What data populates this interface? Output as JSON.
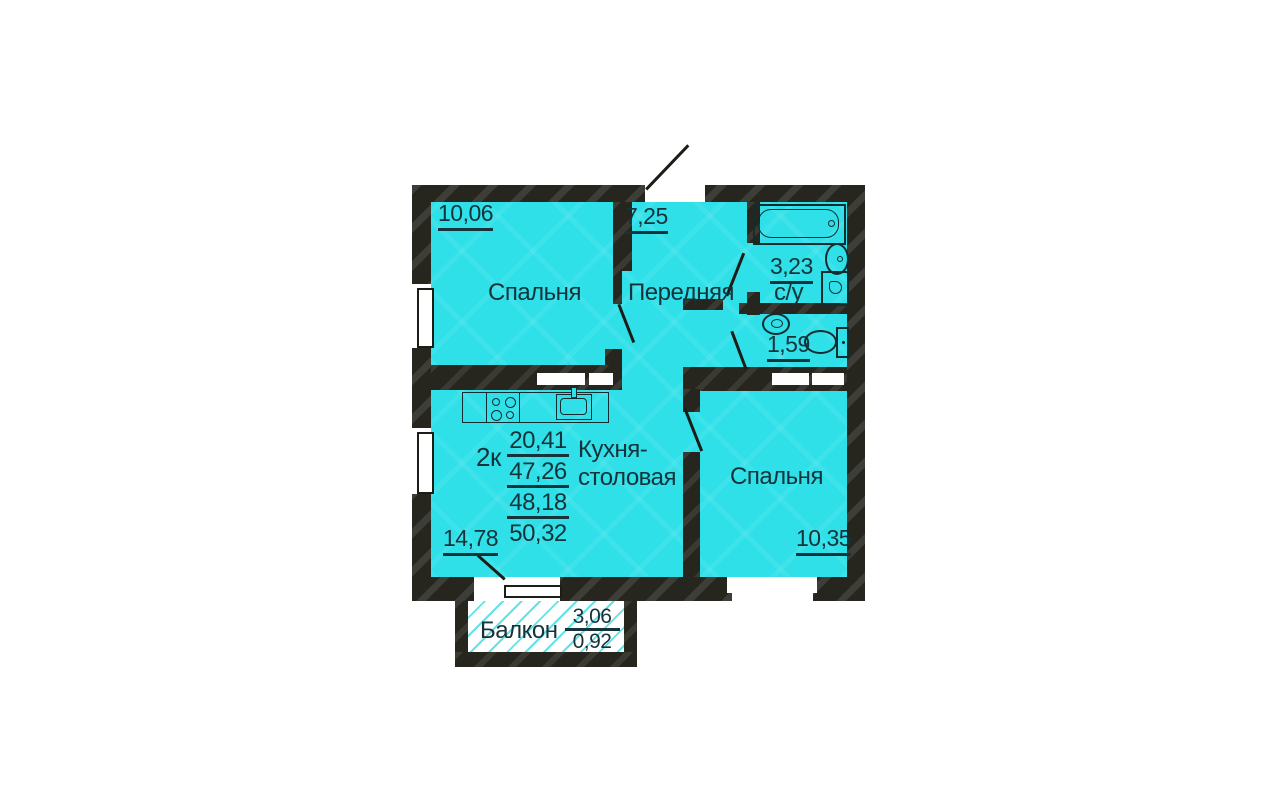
{
  "plan": {
    "apartment_summary": {
      "type_label": "2к",
      "areas": [
        "20,41",
        "47,26",
        "48,18",
        "50,32"
      ]
    },
    "rooms": {
      "bedroom1": {
        "label": "Спальня",
        "area": "10,06"
      },
      "hallway": {
        "label": "Передняя",
        "area": "7,25"
      },
      "bathroom": {
        "label": "с/у",
        "area": "3,23"
      },
      "wc": {
        "area": "1,59"
      },
      "kitchen": {
        "label_line1": "Кухня-",
        "label_line2": "столовая",
        "area": "14,78"
      },
      "bedroom2": {
        "label": "Спальня",
        "area": "10,35"
      },
      "balcony": {
        "label": "Балкон",
        "area_full": "3,06",
        "area_reduced": "0,92"
      }
    },
    "colors": {
      "room_fill": "#2fe0e8",
      "wall": "#26261f",
      "line": "#14333a",
      "background": "#ffffff"
    }
  }
}
